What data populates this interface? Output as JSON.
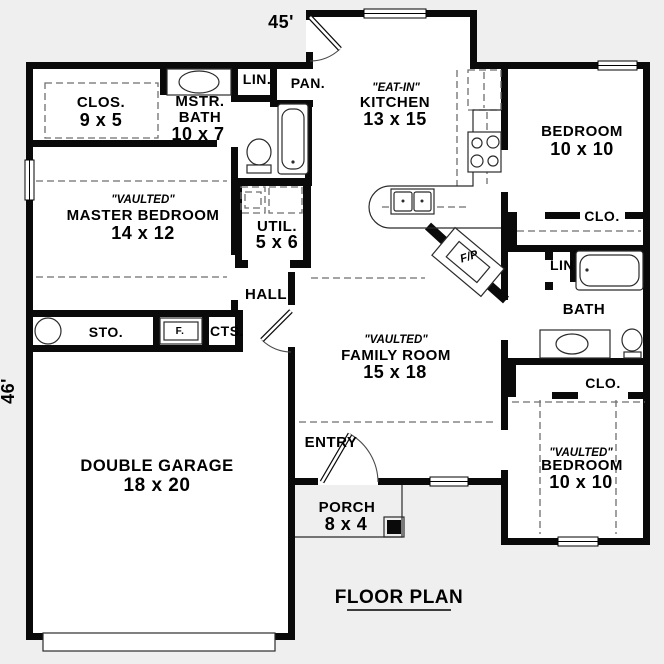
{
  "palette": {
    "background": "#efefef",
    "wall": "#0a0a0a",
    "floor": "#ffffff"
  },
  "plan": {
    "title": "FLOOR PLAN",
    "width_label": "45'",
    "height_label": "46'"
  },
  "rooms": {
    "master_closet": {
      "label": "CLOS.",
      "size": "9 x 5"
    },
    "master_bath": {
      "label1": "MSTR.",
      "label2": "BATH",
      "size": "10 x 7"
    },
    "linen1": {
      "label": "LIN."
    },
    "pantry": {
      "label": "PAN."
    },
    "kitchen": {
      "note": "\"EAT-IN\"",
      "label": "KITCHEN",
      "size": "13 x 15"
    },
    "bedroom2": {
      "label": "BEDROOM",
      "size": "10 x 10"
    },
    "master_bedroom": {
      "note": "\"VAULTED\"",
      "label": "MASTER BEDROOM",
      "size": "14 x 12"
    },
    "utility": {
      "label": "UTIL.",
      "size": "5 x 6"
    },
    "closet2": {
      "label": "CLO."
    },
    "linen2": {
      "label": "LIN"
    },
    "bath2": {
      "label": "BATH"
    },
    "hall": {
      "label": "HALL"
    },
    "storage": {
      "label": "STO."
    },
    "furnace": {
      "label": "F."
    },
    "coats": {
      "label": "CTS."
    },
    "family_room": {
      "note": "\"VAULTED\"",
      "label": "FAMILY ROOM",
      "size": "15 x 18"
    },
    "fireplace": {
      "label": "F/P"
    },
    "entry": {
      "label": "ENTRY"
    },
    "garage": {
      "label": "DOUBLE GARAGE",
      "size": "18 x 20"
    },
    "porch": {
      "label": "PORCH",
      "size": "8 x 4"
    },
    "closet3": {
      "label": "CLO."
    },
    "bedroom3": {
      "note": "\"VAULTED\"",
      "label": "BEDROOM",
      "size": "10 x 10"
    }
  }
}
